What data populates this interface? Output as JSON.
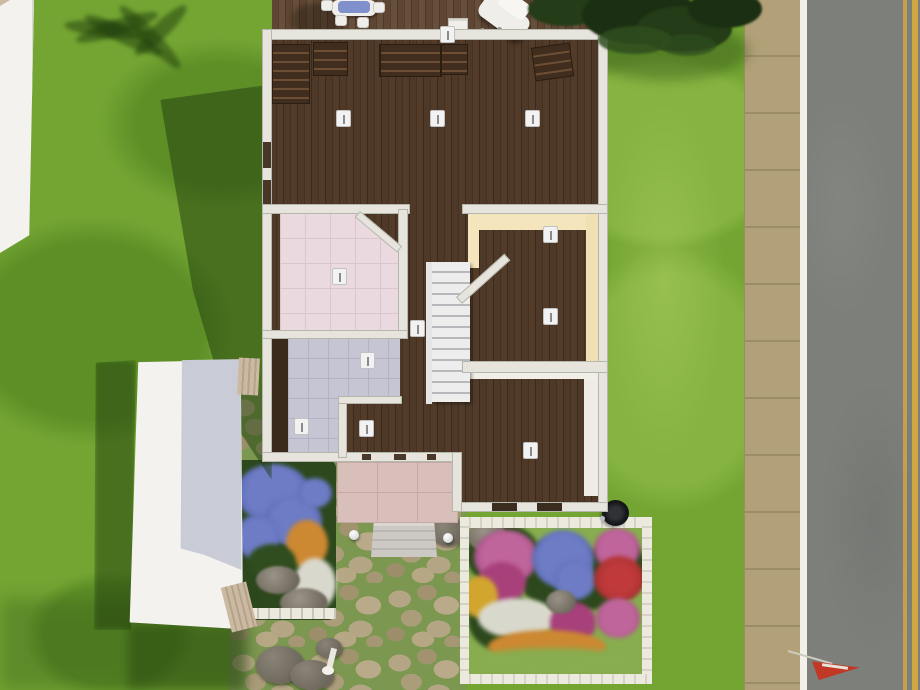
{
  "scene": {
    "description": "top-down lot view of a suburban house in a life-simulation game",
    "view_mode": "floor cutaway, walls-down overhead camera",
    "visible_text": "none"
  },
  "colors": {
    "grass": "#74a533",
    "grass_light": "#86b441",
    "grass_dark": "#5e8f27",
    "shadow": "#1e3c0c",
    "sidewalk": "#b2a178",
    "sidewalk_seam": "#9d8d66",
    "road": "#7d7f7b",
    "road_white_line": "#f3f0e9",
    "road_yellow": "#d2a640",
    "roof_white": "#f3f2ee",
    "roof_shade": "#c9ccd6",
    "fence_tan": "#cbb9a2",
    "wall": "#e7e3dd",
    "wall_edge": "#b4b8ac",
    "wall_cream": "#f4e5bc",
    "wood_dark": "#4e3827",
    "wood_deck": "#5f4633",
    "tile_pink": "#ead9df",
    "tile_pink_line": "#dcc6ce",
    "tile_lavender": "#c6c5d3",
    "tile_lavender_line": "#b4b3c4",
    "tile_porch": "#d9bfba",
    "tile_porch_line": "#c4a9a5",
    "steps": "#ccc8c4",
    "stairs_light": "#ededee",
    "stairs_dark": "#b8b8bc",
    "dresser": "#402d1d",
    "dresser_line": "#6b4e33",
    "light_fixture": "#f2f2f2",
    "stone": "#b4a684",
    "stone_bg": "#7c9750",
    "rock": "#6e685c",
    "tree_dark": "#1b2f12",
    "tree_mid": "#243c17",
    "tree_light": "#2f4d1f",
    "flower_blue": "#6d7cc4",
    "flower_pink": "#c0659c",
    "flower_magenta": "#a8407b",
    "flower_red": "#9e2a2a",
    "flower_orange": "#cd8832",
    "flower_yellow": "#d2a52e",
    "flower_white": "#d9d8cd",
    "foliage": "#2c481c",
    "garden_grass": "#87ad4f",
    "garden_fence": "#eceadf",
    "table_blue": "#8090cc",
    "furniture_white": "#efeeea",
    "trash_black": "#141619",
    "flag_red": "#c23826"
  },
  "objects": {
    "house": {
      "rooms": [
        "wood-floor main room",
        "pink-tile bathroom",
        "lavender-tile room",
        "cream-wall room",
        "wood bottom room",
        "wood hallway"
      ],
      "features": [
        "staircase",
        "wall lights",
        "dressers",
        "porch with steps",
        "rear deck"
      ]
    },
    "yard": [
      "stone path",
      "blue flowerbed",
      "fenced flower garden",
      "boulders",
      "garden globes",
      "sprinkler",
      "trash can"
    ],
    "street": [
      "sidewalk",
      "asphalt road with double yellow line",
      "white edge line",
      "mailbox flag",
      "lamp post",
      "dark pine tree",
      "neighbor roof strips"
    ]
  }
}
